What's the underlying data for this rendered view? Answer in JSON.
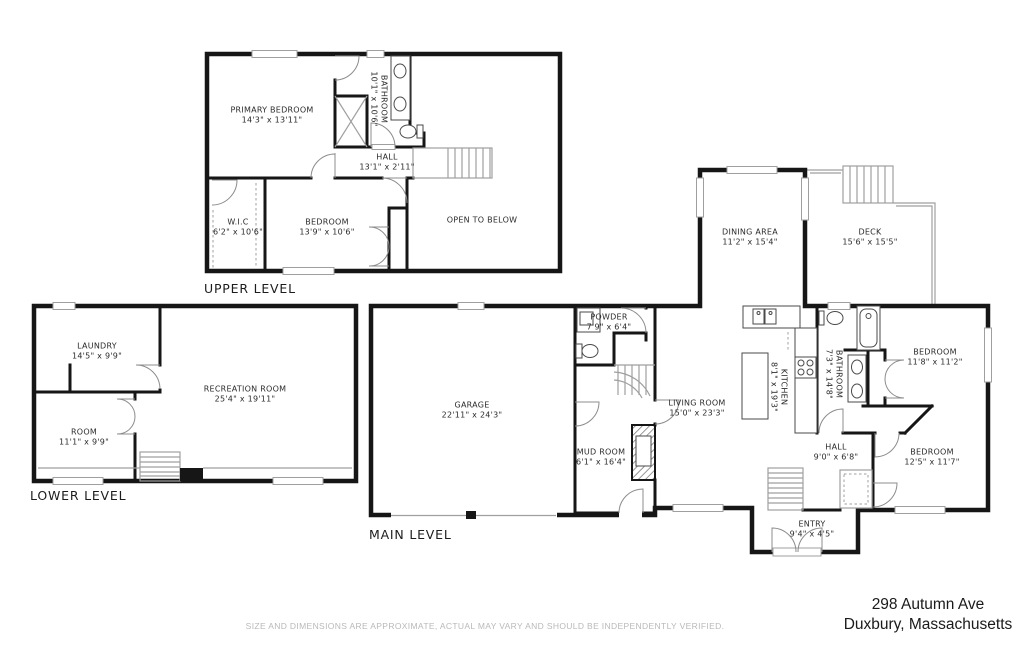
{
  "floorplan": {
    "levels": [
      {
        "id": "upper",
        "title": "UPPER LEVEL",
        "rooms": [
          {
            "name": "PRIMARY BEDROOM",
            "dims": "14'3\" x 13'11\""
          },
          {
            "name": "BATHROOM",
            "dims": "10'1\" x 10'6\""
          },
          {
            "name": "HALL",
            "dims": "13'1\" x 2'11\""
          },
          {
            "name": "W.I.C",
            "dims": "6'2\" x 10'6\""
          },
          {
            "name": "BEDROOM",
            "dims": "13'9\" x 10'6\""
          },
          {
            "name": "OPEN TO BELOW",
            "dims": ""
          }
        ]
      },
      {
        "id": "lower",
        "title": "LOWER LEVEL",
        "rooms": [
          {
            "name": "LAUNDRY",
            "dims": "14'5\" x 9'9\""
          },
          {
            "name": "RECREATION ROOM",
            "dims": "25'4\" x 19'11\""
          },
          {
            "name": "ROOM",
            "dims": "11'1\" x 9'9\""
          }
        ]
      },
      {
        "id": "main",
        "title": "MAIN LEVEL",
        "rooms": [
          {
            "name": "GARAGE",
            "dims": "22'11\" x 24'3\""
          },
          {
            "name": "POWDER",
            "dims": "7'9\" x 6'4\""
          },
          {
            "name": "MUD ROOM",
            "dims": "6'1\" x 16'4\""
          },
          {
            "name": "DINING AREA",
            "dims": "11'2\" x 15'4\""
          },
          {
            "name": "DECK",
            "dims": "15'6\" x 15'5\""
          },
          {
            "name": "KITCHEN",
            "dims": "8'1\" x 19'3\""
          },
          {
            "name": "BATHROOM",
            "dims": "7'3\" x 14'8\""
          },
          {
            "name": "LIVING ROOM",
            "dims": "15'0\" x 23'3\""
          },
          {
            "name": "BEDROOM",
            "dims": "11'8\" x 11'2\""
          },
          {
            "name": "HALL",
            "dims": "9'0\" x 6'8\""
          },
          {
            "name": "BEDROOM",
            "dims": "12'5\" x 11'7\""
          },
          {
            "name": "ENTRY",
            "dims": "9'4\" x 4'5\""
          }
        ]
      }
    ],
    "footer": {
      "disclaimer": "SIZE AND DIMENSIONS ARE APPROXIMATE, ACTUAL MAY VARY AND SHOULD BE INDEPENDENTLY VERIFIED.",
      "address_line1": "298 Autumn Ave",
      "address_line2": "Duxbury, Massachusetts"
    },
    "colors": {
      "wall": "#161616",
      "window": "#9f9f9f",
      "label": "#2b2b2b",
      "disclaimer": "#b9b9b9"
    }
  }
}
